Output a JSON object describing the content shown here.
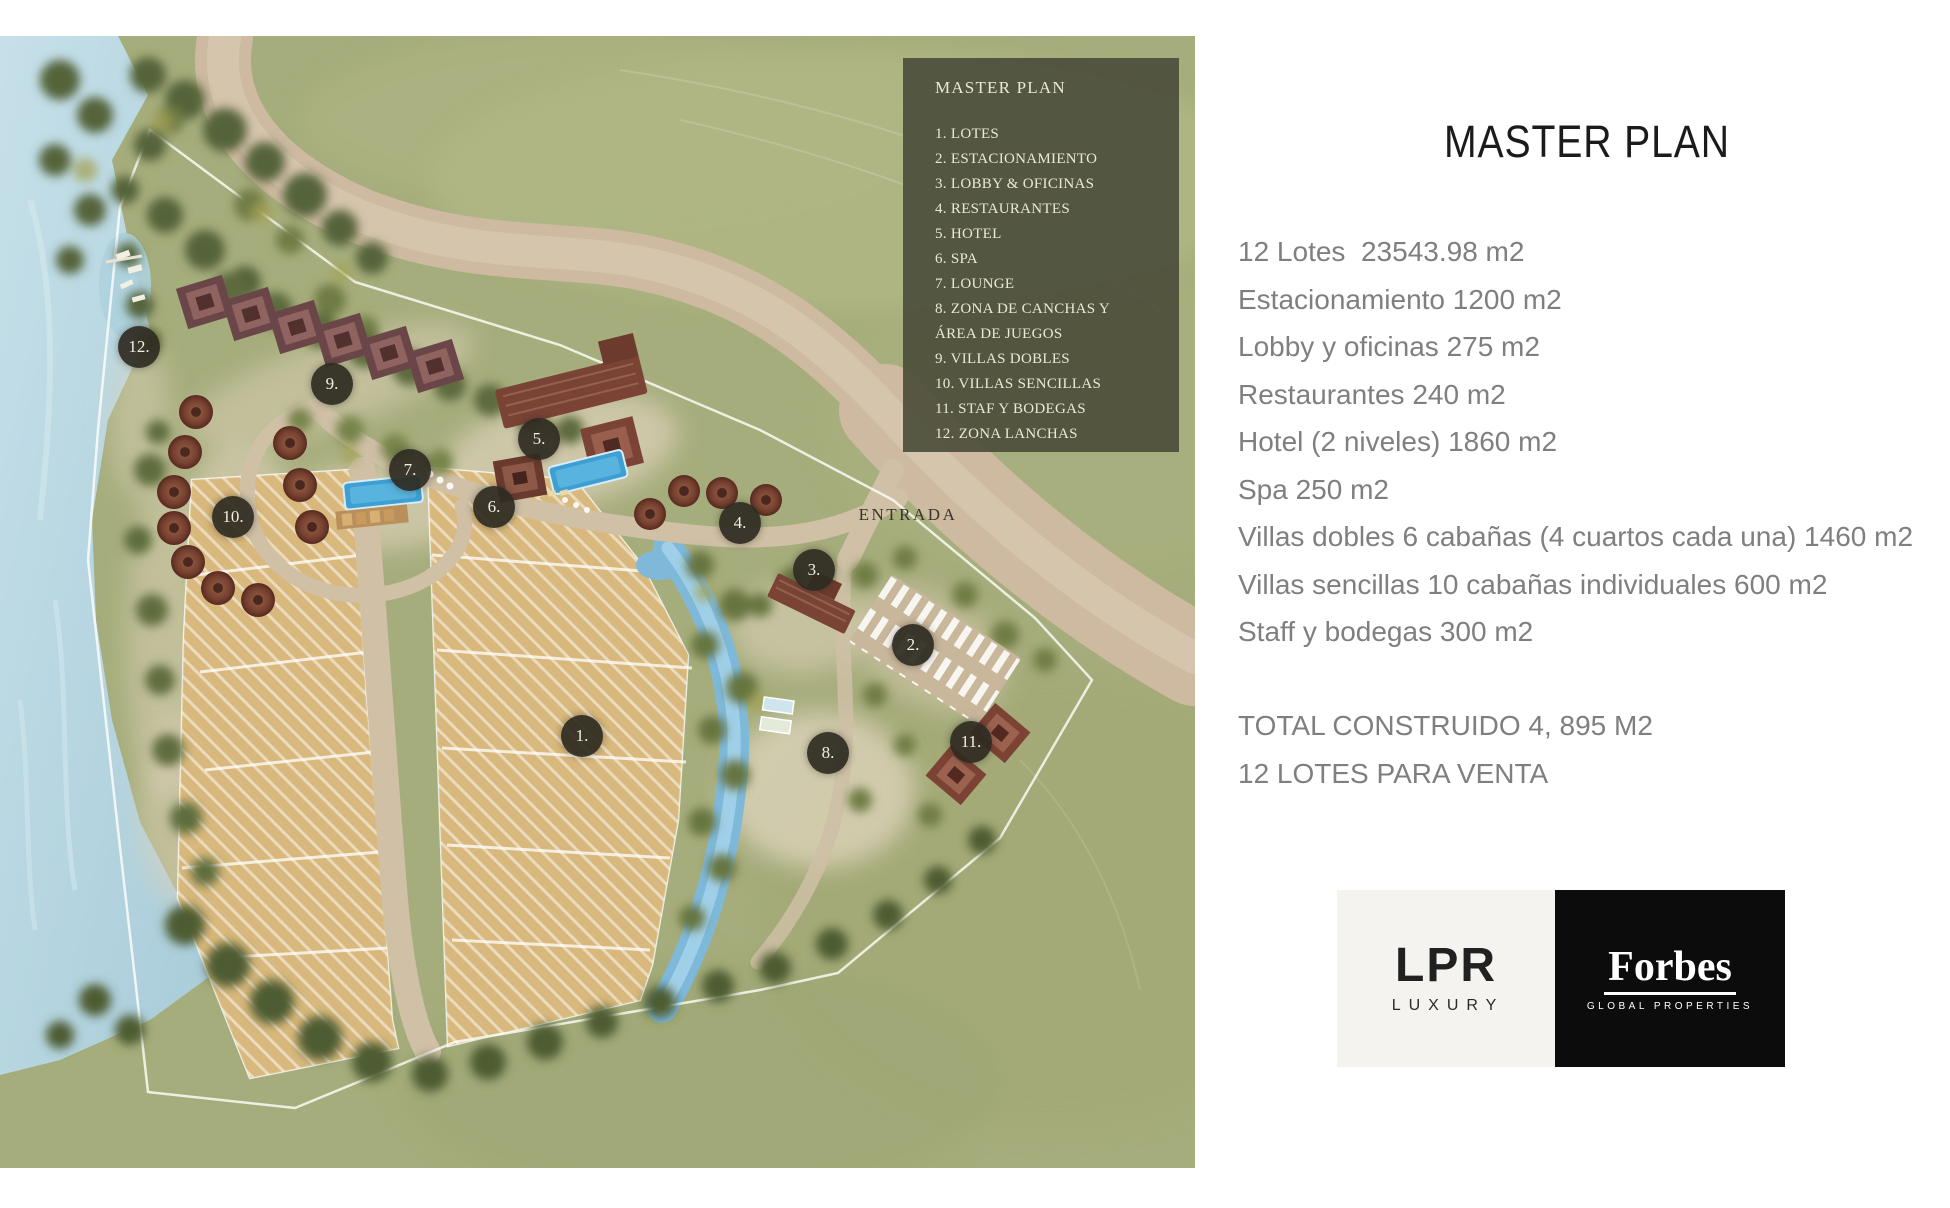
{
  "map": {
    "entrada_label": "ENTRADA",
    "legend": {
      "title": "MASTER PLAN",
      "items": [
        "1. LOTES",
        "2. ESTACIONAMIENTO",
        "3. LOBBY & OFICINAS",
        "4. RESTAURANTES",
        "5. HOTEL",
        "6. SPA",
        "7. LOUNGE",
        "8. ZONA DE CANCHAS Y ÁREA DE JUEGOS",
        "9. VILLAS DOBLES",
        "10. VILLAS SENCILLAS",
        "11. STAF Y BODEGAS",
        "12. ZONA LANCHAS"
      ]
    },
    "markers": [
      {
        "label": "1.",
        "x": 582,
        "y": 736
      },
      {
        "label": "2.",
        "x": 913,
        "y": 645
      },
      {
        "label": "3.",
        "x": 814,
        "y": 570
      },
      {
        "label": "4.",
        "x": 740,
        "y": 523
      },
      {
        "label": "5.",
        "x": 539,
        "y": 439
      },
      {
        "label": "6.",
        "x": 494,
        "y": 507
      },
      {
        "label": "7.",
        "x": 410,
        "y": 470
      },
      {
        "label": "8.",
        "x": 828,
        "y": 753
      },
      {
        "label": "9.",
        "x": 332,
        "y": 384
      },
      {
        "label": "10.",
        "x": 233,
        "y": 517
      },
      {
        "label": "11.",
        "x": 971,
        "y": 742
      },
      {
        "label": "12.",
        "x": 139,
        "y": 347
      }
    ],
    "colors": {
      "legend_bg": "#494b39",
      "marker_bg": "#2e2b21",
      "water": "#b9d8e2",
      "lot_fill": "#d8b87c",
      "road": "#cdbaa1",
      "grass": "#a6ad7c"
    }
  },
  "panel": {
    "title": "MASTER PLAN",
    "lines": [
      "12 Lotes  23543.98 m2",
      "Estacionamiento 1200 m2",
      "Lobby y oficinas 275 m2",
      "Restaurantes 240 m2",
      "Hotel (2 niveles) 1860 m2",
      "Spa 250 m2",
      "Villas dobles 6 cabañas (4 cuartos cada una) 1460 m2",
      "Villas sencillas 10 cabañas individuales 600 m2",
      "Staff y bodegas 300 m2"
    ],
    "totals": [
      "TOTAL CONSTRUIDO 4, 895 M2",
      "12 LOTES PARA VENTA"
    ],
    "text_color": "#7f7f7f",
    "logos": {
      "lpr": {
        "name": "LPR",
        "sub": "LUXURY",
        "bg": "#f4f3f0"
      },
      "forbes": {
        "name": "Forbes",
        "sub": "GLOBAL PROPERTIES",
        "bg": "#0c0c0c"
      }
    }
  }
}
